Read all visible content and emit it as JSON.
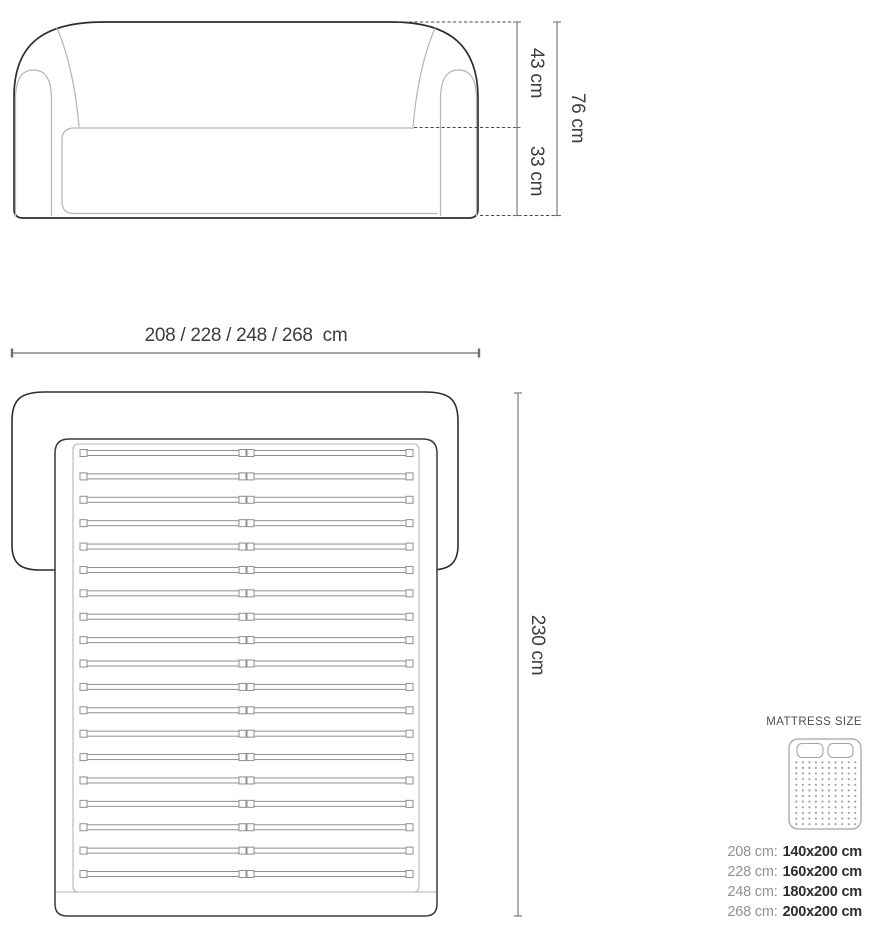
{
  "front_view": {
    "back_height_label": "43 cm",
    "seat_height_label": "33 cm",
    "total_height_label": "76 cm",
    "width_label": "208 / 228 / 248 / 268  cm"
  },
  "top_view": {
    "depth_label": "230 cm",
    "slat_count": 19
  },
  "mattress": {
    "title": "MATTRESS SIZE",
    "sizes": [
      {
        "label": "208 cm:",
        "value": "140x200 cm"
      },
      {
        "label": "228 cm:",
        "value": "160x200 cm"
      },
      {
        "label": "248 cm:",
        "value": "180x200 cm"
      },
      {
        "label": "268 cm:",
        "value": "200x200 cm"
      }
    ]
  },
  "colors": {
    "outline": "#2e2e2e",
    "inner_line": "#b5b5b5",
    "slat_line": "#8f8f8f",
    "dimension_line": "#6e6e6e",
    "dashed_line": "#4a4a4a",
    "text": "#3d3d3d"
  }
}
